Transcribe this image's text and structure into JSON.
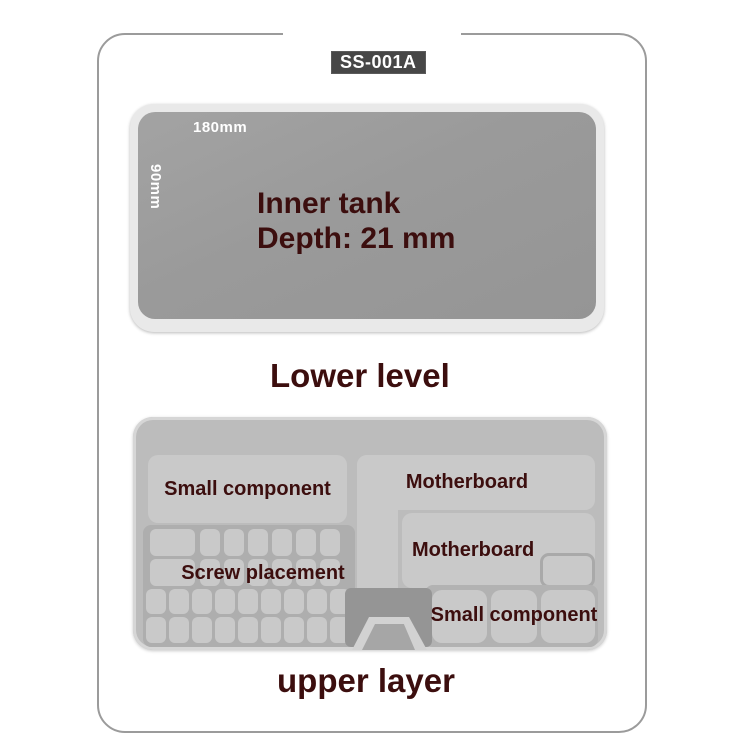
{
  "product": {
    "model": "SS-001A"
  },
  "colors": {
    "accent_text": "#3c0e0e",
    "badge_bg": "#474747",
    "badge_text": "#ffffff",
    "tank_fill": "#9c9c9c",
    "tank_rim": "#e9e9e9",
    "tray_fill": "#bcbcbc",
    "compartment_fill": "#c9c9c9",
    "dimension_text": "#ffffff",
    "frame_border": "#9b9b9b"
  },
  "lower_section": {
    "tank": {
      "width_label": "180mm",
      "depth_side_label": "90mm",
      "annotation_line1": "Inner tank",
      "annotation_line2": "Depth: 21 mm"
    },
    "caption": "Lower level"
  },
  "upper_section": {
    "caption": "upper layer",
    "labels": {
      "small_component_left": "Small component",
      "screw_placement": "Screw placement",
      "motherboard_top": "Motherboard",
      "motherboard_middle": "Motherboard",
      "small_component_right": "Small component"
    }
  }
}
